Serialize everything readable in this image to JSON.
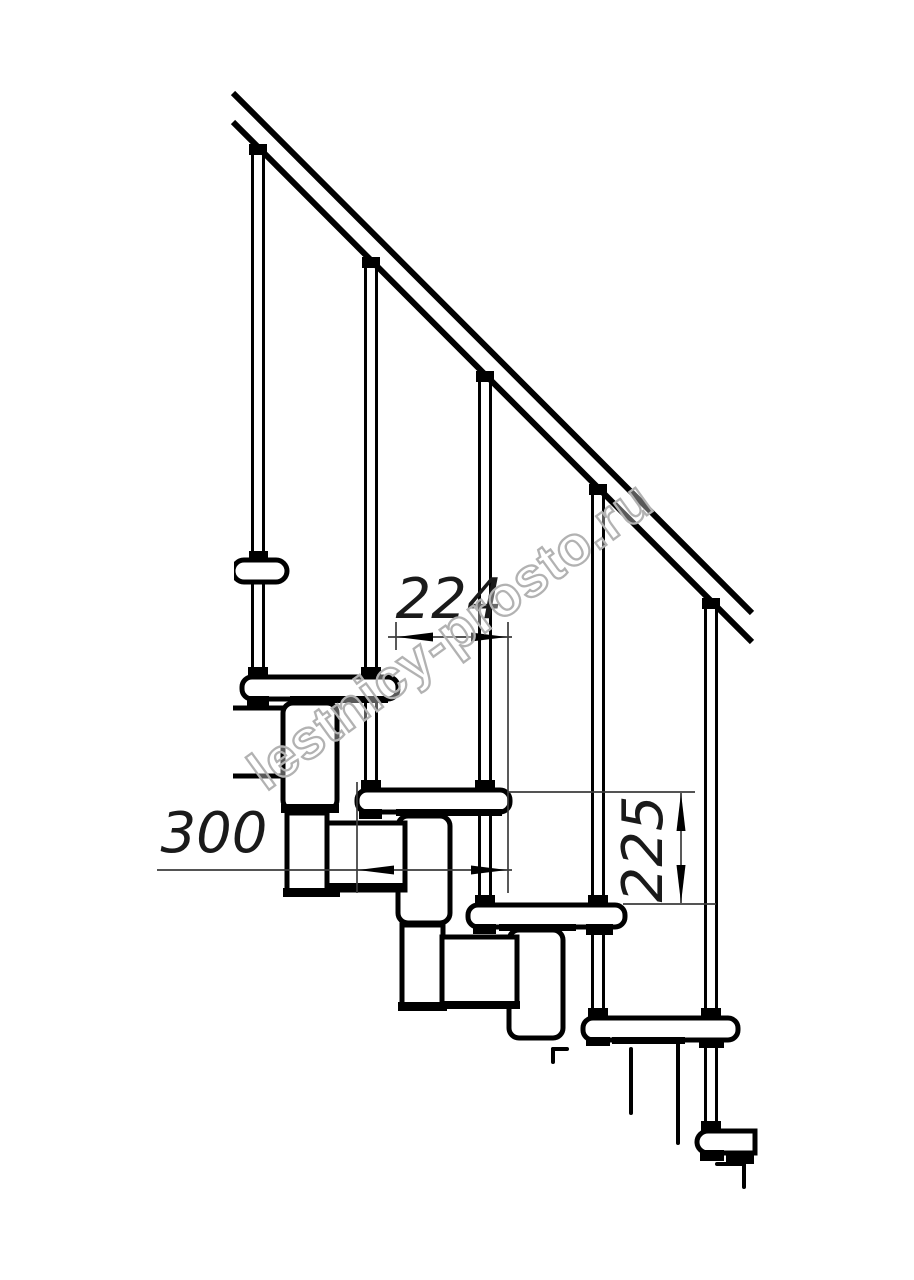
{
  "watermark": {
    "text": "lestnicy-prosto.ru",
    "outline_color": "#b2b2b2"
  },
  "dimensions": {
    "step_offset": {
      "value": "224"
    },
    "tread_depth": {
      "value": "300"
    },
    "riser_height": {
      "value": "225"
    }
  },
  "drawing": {
    "subject": "modular staircase side elevation",
    "handrail": "diagonal handrail",
    "balusters_count": 5,
    "treads_count": 5,
    "line_color": "#000000",
    "background_color": "#ffffff"
  }
}
